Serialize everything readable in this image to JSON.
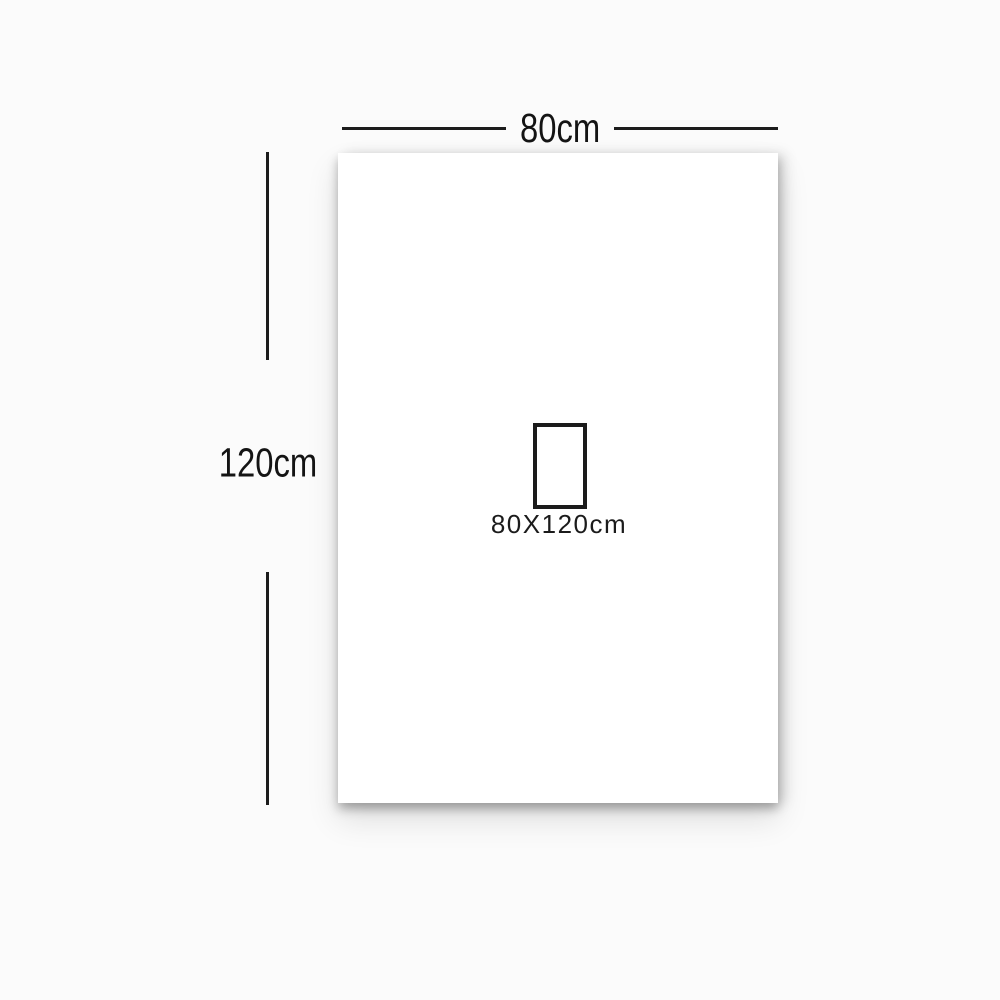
{
  "diagram": {
    "type": "product-size-diagram",
    "width_dimension": {
      "label": "80cm",
      "value_cm": 80
    },
    "height_dimension": {
      "label": "120cm",
      "value_cm": 120
    },
    "size_callout": {
      "label": "80X120cm"
    }
  },
  "colors": {
    "background": "#fbfbfb",
    "panel": "#ffffff",
    "dimension_line": "#1c1c1c",
    "text": "#141414"
  }
}
